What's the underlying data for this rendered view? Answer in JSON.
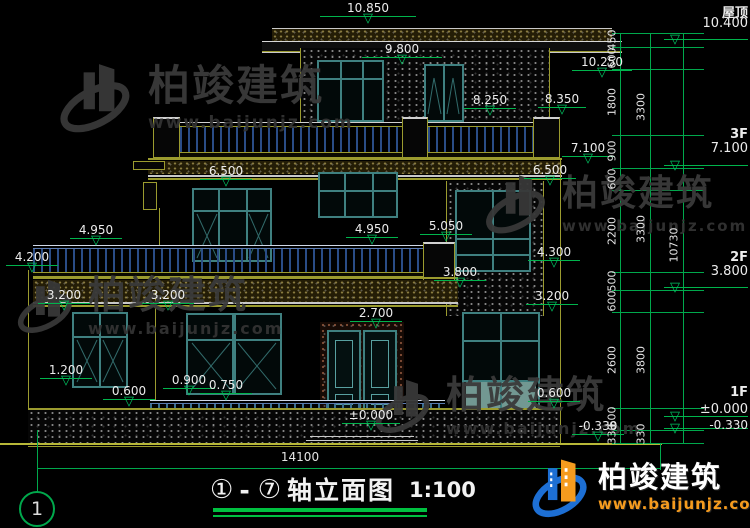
{
  "drawing": {
    "type": "architectural-elevation",
    "scale": "1:100",
    "background": "#000000"
  },
  "title": {
    "prefix": "①",
    "dash": "-",
    "suffix": "⑦",
    "text": "轴立面图",
    "scale": "1:100"
  },
  "axis": {
    "bubble_left": "1"
  },
  "elev": [
    "10.850",
    "9.800",
    "10.250",
    "8.250",
    "8.350",
    "7.100",
    "6.500",
    "6.500",
    "4.950",
    "4.200",
    "4.950",
    "5.050",
    "3.800",
    "4.300",
    "3.200",
    "3.200",
    "3.200",
    "2.700",
    "1.200",
    "0.900",
    "0.750",
    "0.600",
    "0.600",
    "±0.000",
    "-0.330"
  ],
  "levels_right": {
    "roof": {
      "label": "屋顶",
      "value": "10.400"
    },
    "f3": {
      "label": "3F",
      "value": "7.100"
    },
    "f2": {
      "label": "2F",
      "value": "3.800"
    },
    "f1": {
      "label": "1F",
      "value": "±0.000",
      "below": "-0.330"
    }
  },
  "dims": {
    "inner": [
      "450",
      "600",
      "1800",
      "900",
      "600",
      "2200",
      "500",
      "600",
      "2600",
      "600",
      "330"
    ],
    "middle": [
      "3300",
      "3300",
      "3800",
      "330"
    ],
    "outer": [
      "10730"
    ],
    "width_total": "14100"
  },
  "watermark": {
    "name": "柏竣建筑",
    "url": "www.baijunjz.com"
  },
  "logo": {
    "name": "柏竣建筑",
    "url": "www.baijunjz.com"
  },
  "icons": {
    "tri": "▽"
  },
  "colors": {
    "dim_green": "#00a84c",
    "frame_teal": "#3f8080",
    "line_yellow": "#9b9b2f",
    "bar_navy": "#2a4c86",
    "bar_blue": "#3a6f8f",
    "text_white": "#ececec",
    "logo_blue": "#1d6fd4",
    "logo_orange": "#f59b1e"
  }
}
